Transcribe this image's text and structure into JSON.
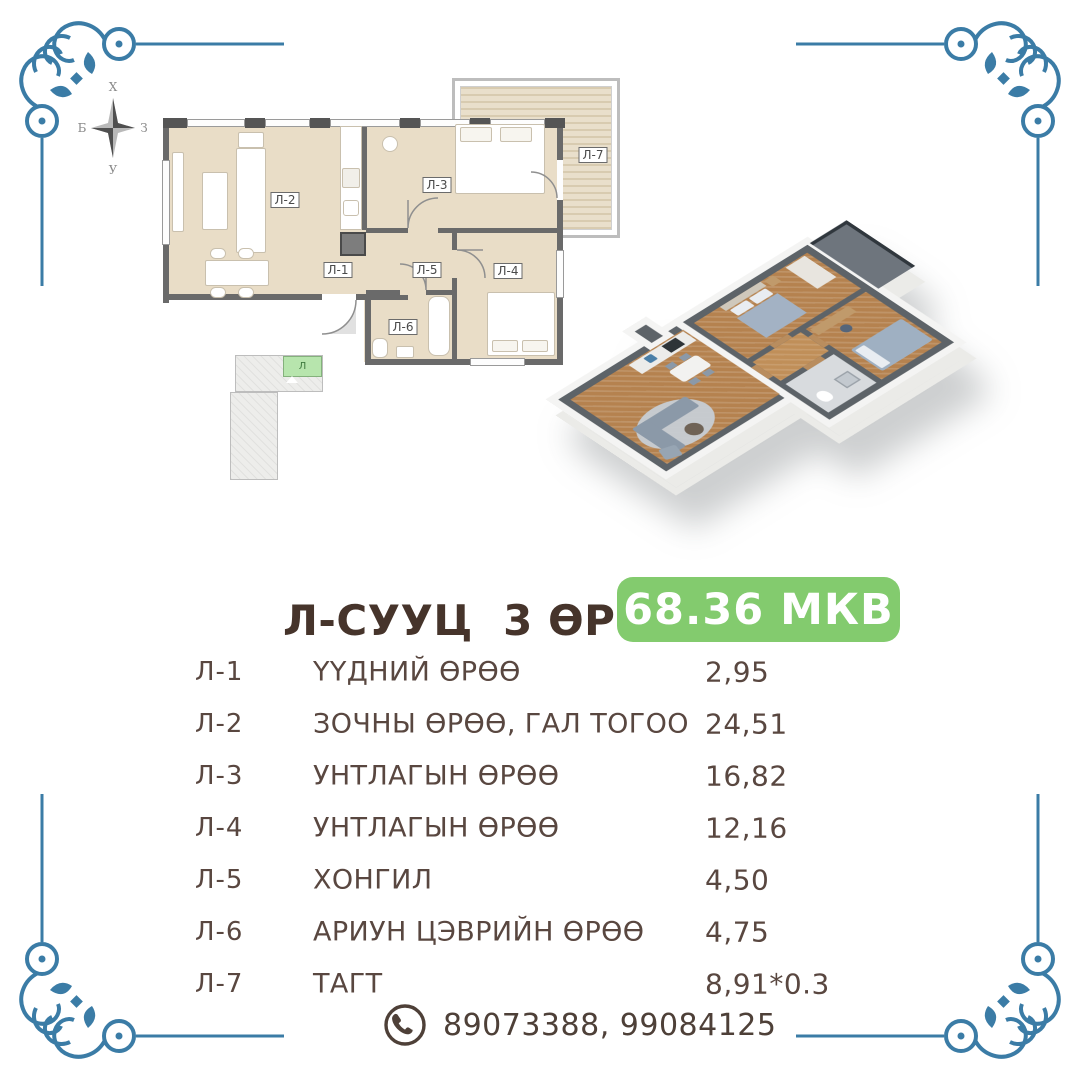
{
  "compass": {
    "north": "Х",
    "east": "З",
    "south": "У",
    "west": "Б"
  },
  "floorplan": {
    "labels": {
      "l1": "Л-1",
      "l2": "Л-2",
      "l3": "Л-3",
      "l4": "Л-4",
      "l5": "Л-5",
      "l6": "Л-6",
      "l7": "Л-7"
    },
    "keyplan_unit": "Л"
  },
  "listing": {
    "title": "Л-СУУЦ  3 ӨРӨӨ",
    "area_badge": "68.36 МКВ"
  },
  "rooms_table": {
    "rows": [
      {
        "code": "Л-1",
        "name": "ҮҮДНИЙ ӨРӨӨ",
        "area": "2,95"
      },
      {
        "code": "Л-2",
        "name": "ЗОЧНЫ ӨРӨӨ, ГАЛ ТОГОО",
        "area": "24,51"
      },
      {
        "code": "Л-3",
        "name": "УНТЛАГЫН ӨРӨӨ",
        "area": "16,82"
      },
      {
        "code": "Л-4",
        "name": "УНТЛАГЫН ӨРӨӨ",
        "area": "12,16"
      },
      {
        "code": "Л-5",
        "name": "ХОНГИЛ",
        "area": "4,50"
      },
      {
        "code": "Л-6",
        "name": "АРИУН ЦЭВРИЙН ӨРӨӨ",
        "area": "4,75"
      },
      {
        "code": "Л-7",
        "name": "ТАГТ",
        "area": "8,91*0.3"
      }
    ]
  },
  "contact": {
    "phones": "89073388, 99084125"
  },
  "colors": {
    "ornament_blue": "#3b7ca6",
    "badge_green": "#83cb6e",
    "keyplan_green": "#b7e5ad",
    "plan_floor_beige": "#e9ddc7",
    "plan_wall_gray": "#6a6a6a",
    "text_brown": "#594740",
    "title_brown": "#46342b"
  }
}
